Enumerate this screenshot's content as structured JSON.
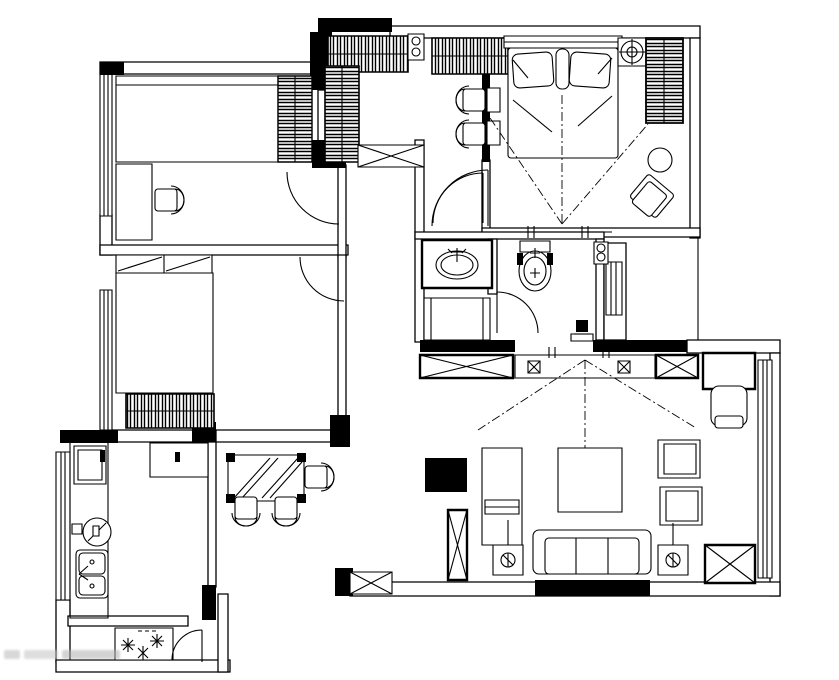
{
  "meta": {
    "title": "apartment-floor-plan",
    "description": "black-and-white architectural floor plan with furniture symbols, no text labels",
    "canvas": {
      "width": 839,
      "height": 680
    }
  },
  "colors": {
    "background": "#ffffff",
    "line": "#000000",
    "wall_fill": "#000000",
    "watermark": "#bbbbbb"
  },
  "watermark": {
    "present": true,
    "legible": false,
    "text": ""
  },
  "rooms": [
    {
      "id": "study-bedroom",
      "position": "top-left",
      "furniture": [
        "single-bed",
        "side-wardrobe",
        "desk",
        "office-chair",
        "swing-door",
        "window-left"
      ]
    },
    {
      "id": "second-bedroom",
      "position": "middle-left",
      "furniture": [
        "double-bed",
        "sliding-closet",
        "dresser",
        "swing-door",
        "window-left"
      ]
    },
    {
      "id": "walk-in-closet",
      "position": "top-center",
      "furniture": [
        "wardrobe-top-left",
        "wardrobe-top-right",
        "wardrobe-side",
        "storage-bench",
        "chair-1",
        "chair-2",
        "pipe-column",
        "swing-door"
      ]
    },
    {
      "id": "master-bedroom",
      "position": "top-right",
      "furniture": [
        "double-bed",
        "pillows",
        "headboard",
        "bedside-table-1",
        "bedside-table-2",
        "air-conditioner",
        "wardrobe",
        "lounge-chair",
        "round-side-table",
        "sliding-partition",
        "view-cone"
      ]
    },
    {
      "id": "bathroom-vanity",
      "position": "center",
      "furniture": [
        "washbasin-counter",
        "shower-stall",
        "swing-door"
      ]
    },
    {
      "id": "toilet-room",
      "position": "center",
      "furniture": [
        "toilet",
        "swing-door",
        "small-appliance",
        "pipe-column",
        "duct-window"
      ]
    },
    {
      "id": "living-room",
      "position": "bottom-right",
      "furniture": [
        "storage-cabinet-left",
        "media-wall-cabinet",
        "storage-cabinet-right",
        "desk",
        "desk-chair",
        "tv-cabinet",
        "tv",
        "coffee-table",
        "three-seat-sofa",
        "lamp-side-table-left",
        "lamp-side-table-right",
        "armchair-upper",
        "armchair-lower",
        "plant-stand",
        "tall-cabinet",
        "shoe-cabinet",
        "window-right",
        "view-cone"
      ]
    },
    {
      "id": "dining-area",
      "position": "bottom-center",
      "furniture": [
        "dining-table",
        "dining-chair-1",
        "dining-chair-2",
        "dining-chair-3"
      ]
    },
    {
      "id": "kitchen",
      "position": "bottom-left",
      "furniture": [
        "refrigerator",
        "l-counter",
        "gas-stove",
        "double-sink",
        "island-table",
        "window-left"
      ]
    },
    {
      "id": "balcony",
      "position": "bottom-left-corner",
      "furniture": [
        "planter-box",
        "flowers",
        "swing-door"
      ]
    }
  ],
  "symbols": {
    "wardrobe": "hatched-bar rectangle",
    "window": "multi-line strip in wall",
    "cabinet": "rectangle with X cross",
    "door": "quarter-circle swing arc",
    "column": "solid black block"
  }
}
